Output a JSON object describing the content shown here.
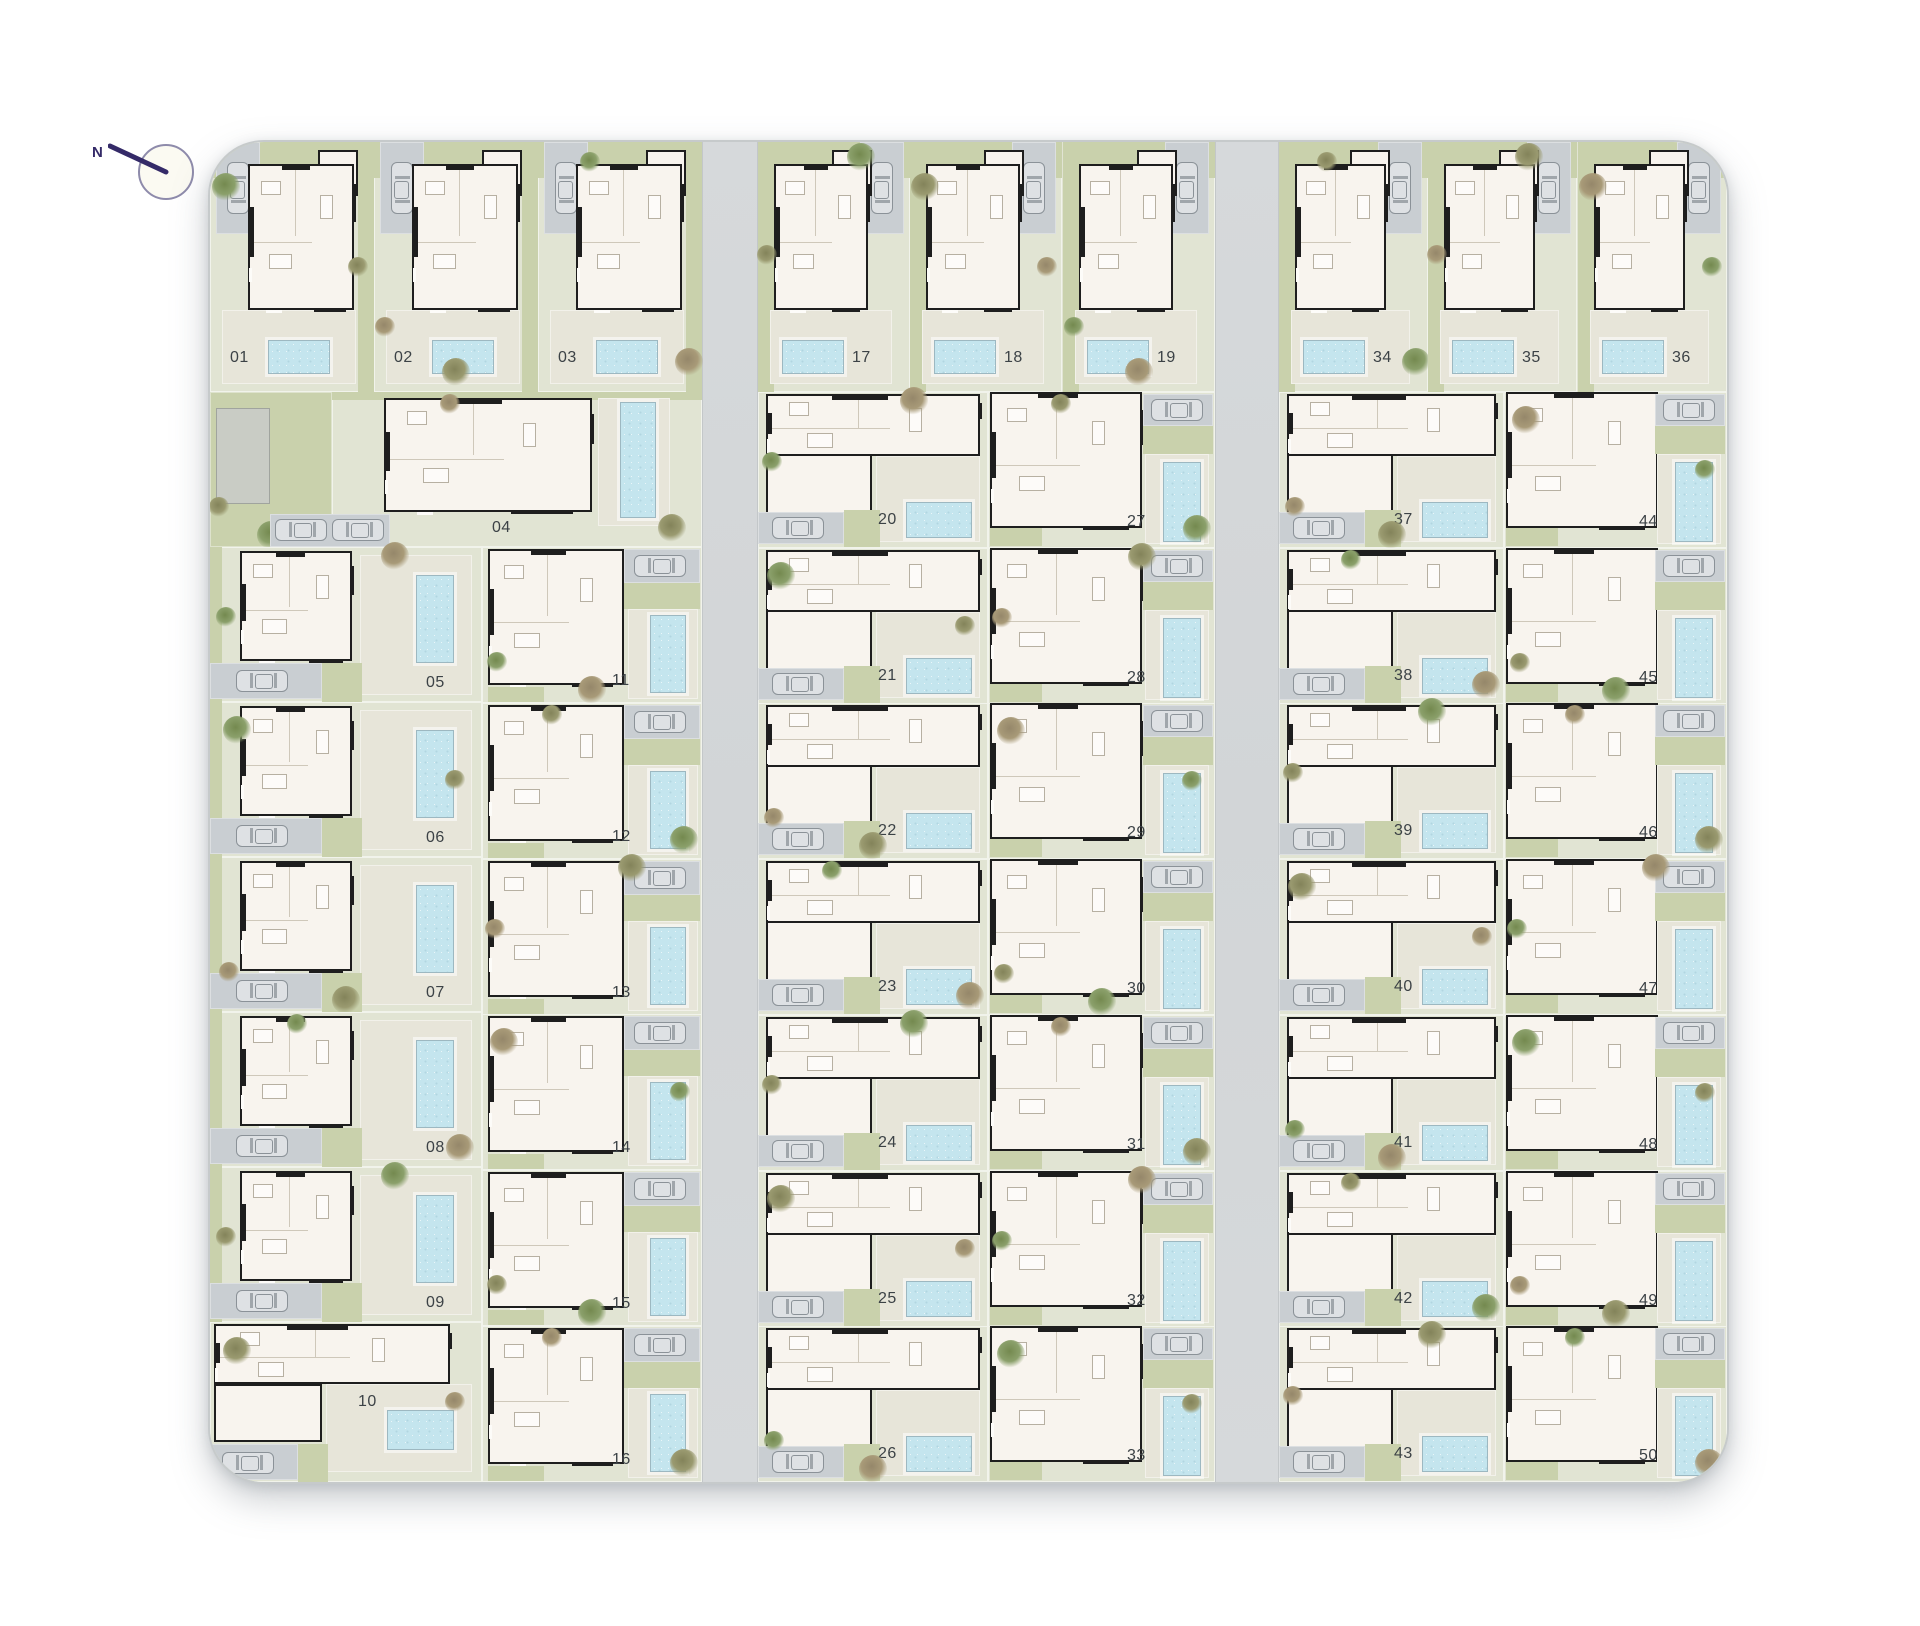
{
  "compass": {
    "label": "N"
  },
  "colors": {
    "plot": "#e1e4d3",
    "patio": "#e7e5d9",
    "garden": "#c9d1ac",
    "pool": "#c4e5ee",
    "house": "#f8f4ee",
    "wall": "#1e1e1e",
    "road": "#d4d7d9",
    "driveway": "#c9ced2",
    "carstroke": "#8b9298",
    "building": "#c9ccc5",
    "labelcolor": "#3c4246",
    "needle": "#342a68"
  },
  "plots": {
    "top_left_row": [
      "01",
      "02",
      "03"
    ],
    "top_middle_row": [
      "17",
      "18",
      "19"
    ],
    "top_right_row": [
      "34",
      "35",
      "36"
    ],
    "plot_04": "04",
    "west_column": [
      "05",
      "06",
      "07",
      "08",
      "09"
    ],
    "plot_10": "10",
    "inner_west_column": [
      "11",
      "12",
      "13",
      "14",
      "15",
      "16"
    ],
    "middle_west_column": [
      "20",
      "21",
      "22",
      "23",
      "24",
      "25",
      "26"
    ],
    "middle_east_column": [
      "27",
      "28",
      "29",
      "30",
      "31",
      "32",
      "33"
    ],
    "east_west_column": [
      "37",
      "38",
      "39",
      "40",
      "41",
      "42",
      "43"
    ],
    "east_east_column": [
      "44",
      "45",
      "46",
      "47",
      "48",
      "49",
      "50"
    ]
  }
}
